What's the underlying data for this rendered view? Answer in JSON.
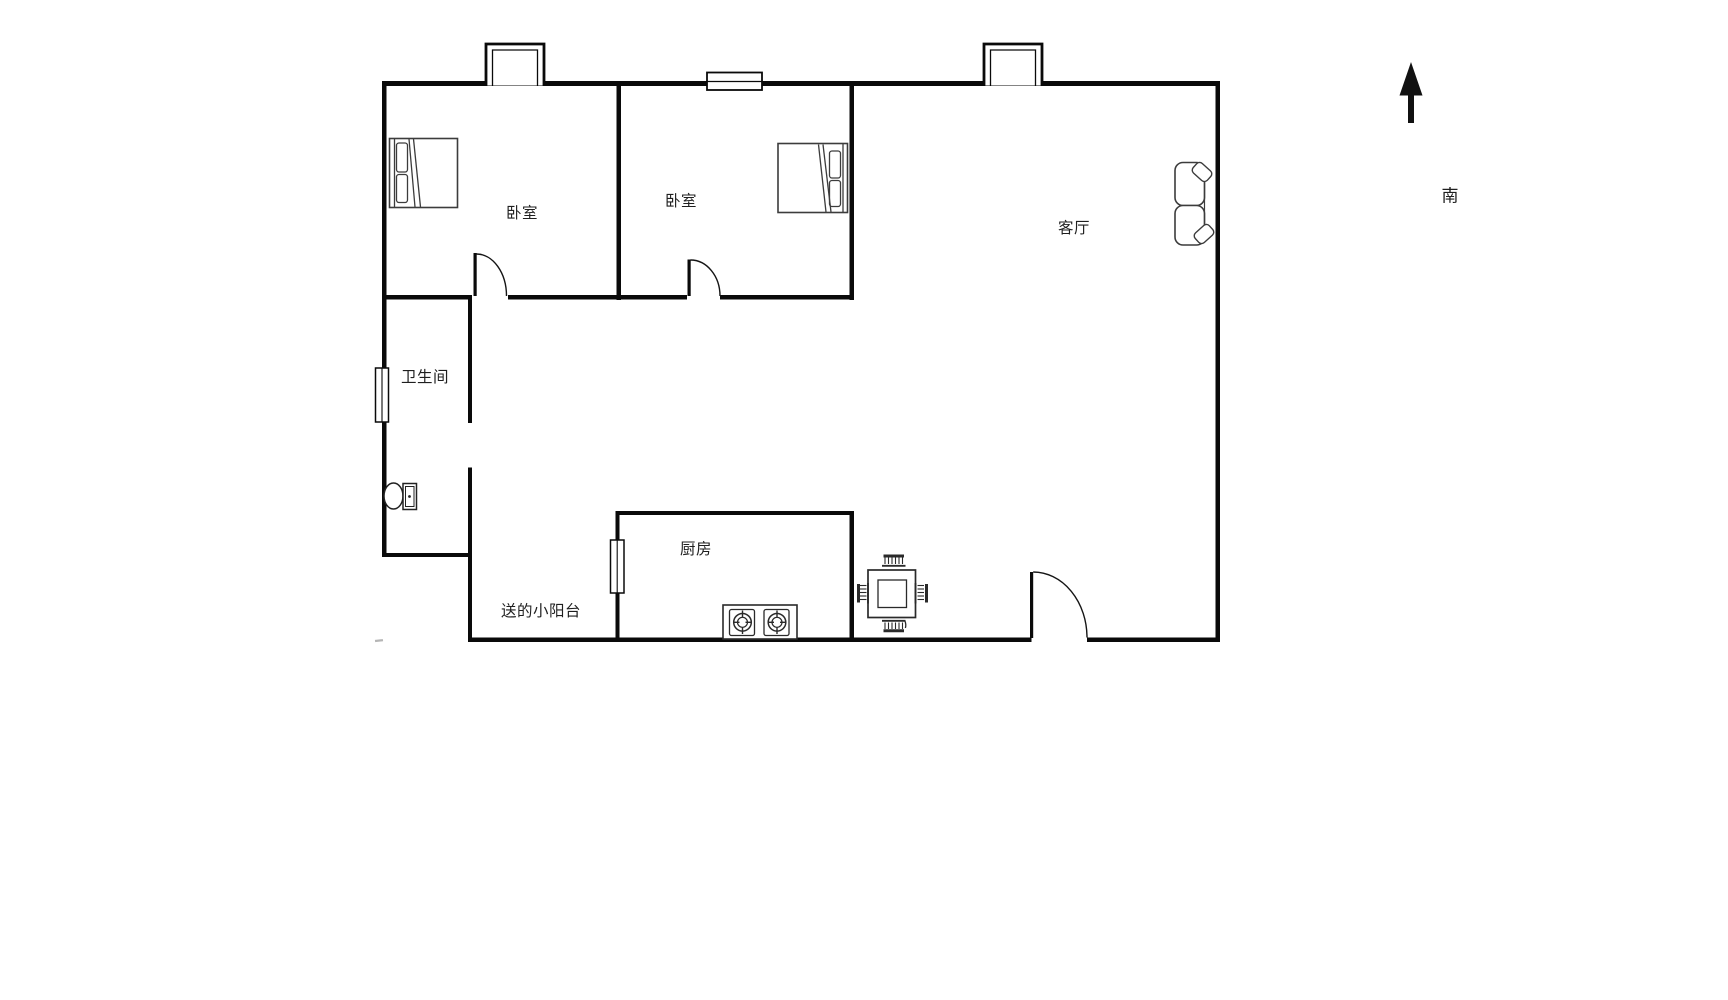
{
  "rooms": {
    "bedroom1": {
      "label": "卧室"
    },
    "bedroom2": {
      "label": "卧室"
    },
    "living_room": {
      "label": "客厅"
    },
    "bathroom": {
      "label": "卫生间"
    },
    "kitchen": {
      "label": "厨房"
    },
    "balcony": {
      "label": "送的小阳台"
    }
  },
  "compass": {
    "south_label": "南",
    "arrow": "north-arrow"
  },
  "furniture_icons": [
    "double-bed",
    "double-bed",
    "sofa",
    "toilet",
    "gas-stove-two-burners",
    "dining-table-four-chairs"
  ],
  "colors": {
    "background": "#ffffff",
    "wall": "#0a0a0a",
    "furniture_stroke": "#3c3c3c",
    "label_text": "#1f1f1f"
  }
}
